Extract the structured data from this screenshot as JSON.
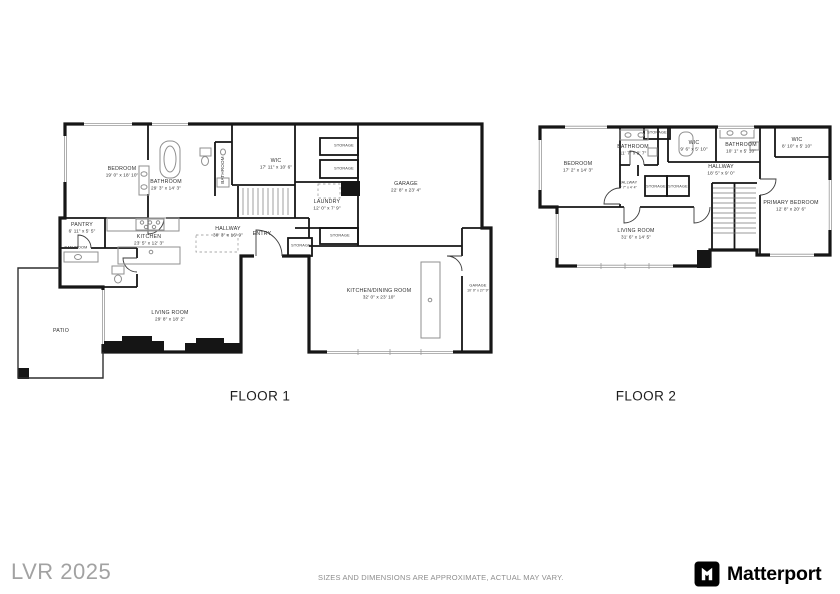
{
  "floors": [
    {
      "label": "FLOOR 1",
      "rooms": [
        {
          "name": "BEDROOM",
          "dims": "19' 0\" x 18' 10\""
        },
        {
          "name": "BATHROOM",
          "dims": "29' 3\" x 14' 3\""
        },
        {
          "name": "WIC",
          "dims": "17' 11\" x 10' 6\""
        },
        {
          "name": "BATHROOM"
        },
        {
          "name": "STORAGE"
        },
        {
          "name": "STORAGE"
        },
        {
          "name": "LAUNDRY",
          "dims": "12' 0\" x 7' 9\""
        },
        {
          "name": "STORAGE"
        },
        {
          "name": "GARAGE",
          "dims": "22' 8\" x 23' 4\""
        },
        {
          "name": "PANTRY",
          "dims": "6' 11\" x 5' 5\""
        },
        {
          "name": "KITCHEN",
          "dims": "23' 5\" x 12' 3\""
        },
        {
          "name": "HALLWAY",
          "dims": "30' 3\" x 16' 9\""
        },
        {
          "name": "ENTRY"
        },
        {
          "name": "STORAGE"
        },
        {
          "name": "BATHROOM"
        },
        {
          "name": "LIVING ROOM",
          "dims": "29' 8\" x 18' 2\""
        },
        {
          "name": "PATIO"
        },
        {
          "name": "KITCHEN/DINING ROOM",
          "dims": "32' 0\" x 23' 10\""
        },
        {
          "name": "GARAGE",
          "dims": "10' 0\" x 27' 9\""
        }
      ]
    },
    {
      "label": "FLOOR 2",
      "rooms": [
        {
          "name": "BEDROOM",
          "dims": "17' 2\" x 14' 3\""
        },
        {
          "name": "BATHROOM",
          "dims": "11' 7\" x 9' 7\""
        },
        {
          "name": "STORAGE"
        },
        {
          "name": "HALLWAY",
          "dims": "6' 7\" x 4' 4\""
        },
        {
          "name": "STORAGE"
        },
        {
          "name": "STORAGE"
        },
        {
          "name": "WIC",
          "dims": "9' 6\" x 5' 10\""
        },
        {
          "name": "BATHROOM",
          "dims": "10' 1\" x 5' 10\""
        },
        {
          "name": "WIC",
          "dims": "8' 10\" x 5' 10\""
        },
        {
          "name": "HALLWAY",
          "dims": "18' 5\" x 9' 0\""
        },
        {
          "name": "LIVING ROOM",
          "dims": "31' 6\" x 14' 5\""
        },
        {
          "name": "PRIMARY BEDROOM",
          "dims": "12' 8\" x 20' 6\""
        }
      ]
    }
  ],
  "footer": {
    "left_text": "LVR 2025",
    "disclaimer": "SIZES AND DIMENSIONS ARE APPROXIMATE, ACTUAL MAY VARY.",
    "brand": "Matterport"
  },
  "colors": {
    "wall": "#161616",
    "label": "#303030",
    "footer_gray": "#a2a2a2",
    "brand_black": "#000000"
  }
}
